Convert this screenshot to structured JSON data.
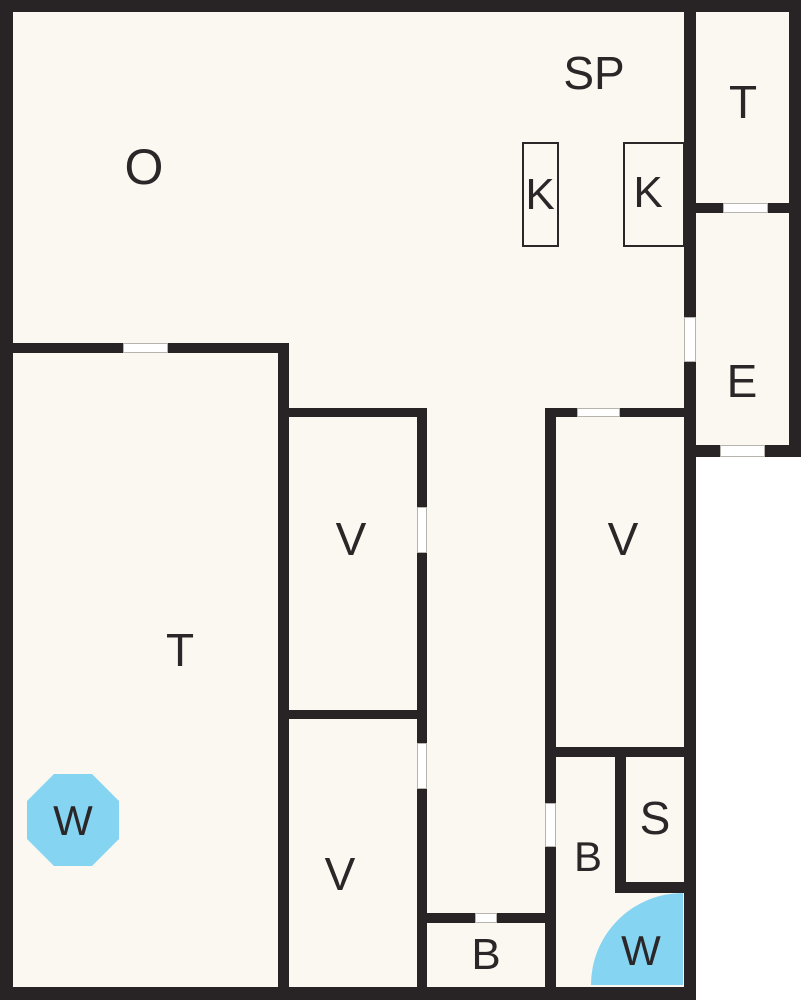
{
  "plan": {
    "canvas": {
      "width": 801,
      "height": 1000
    },
    "colors": {
      "outside": "#ffffff",
      "floor": "#faf8f1",
      "wall": "#282324",
      "door": "#ffffff",
      "door_frame": "#b7b3ad",
      "water": "#85d4f1",
      "text": "#2b2627"
    },
    "floors": [
      {
        "x": 13,
        "y": 12,
        "w": 671,
        "h": 975
      },
      {
        "x": 696,
        "y": 12,
        "w": 93,
        "h": 433
      }
    ],
    "walls": [
      {
        "x": 0,
        "y": 0,
        "w": 801,
        "h": 12
      },
      {
        "x": 0,
        "y": 0,
        "w": 13,
        "h": 1000
      },
      {
        "x": 0,
        "y": 987,
        "w": 696,
        "h": 13
      },
      {
        "x": 789,
        "y": 0,
        "w": 12,
        "h": 457
      },
      {
        "x": 684,
        "y": 0,
        "w": 12,
        "h": 317
      },
      {
        "x": 684,
        "y": 362,
        "w": 12,
        "h": 638
      },
      {
        "x": 684,
        "y": 445,
        "w": 36,
        "h": 12
      },
      {
        "x": 765,
        "y": 445,
        "w": 36,
        "h": 12
      },
      {
        "x": 684,
        "y": 203,
        "w": 39,
        "h": 10
      },
      {
        "x": 768,
        "y": 203,
        "w": 33,
        "h": 10
      },
      {
        "x": 0,
        "y": 343,
        "w": 123,
        "h": 10
      },
      {
        "x": 168,
        "y": 343,
        "w": 121,
        "h": 10
      },
      {
        "x": 278,
        "y": 343,
        "w": 11,
        "h": 644
      },
      {
        "x": 289,
        "y": 408,
        "w": 138,
        "h": 9
      },
      {
        "x": 417,
        "y": 408,
        "w": 10,
        "h": 99
      },
      {
        "x": 417,
        "y": 553,
        "w": 10,
        "h": 190
      },
      {
        "x": 417,
        "y": 789,
        "w": 10,
        "h": 198
      },
      {
        "x": 289,
        "y": 710,
        "w": 128,
        "h": 9
      },
      {
        "x": 545,
        "y": 408,
        "w": 32,
        "h": 9
      },
      {
        "x": 620,
        "y": 408,
        "w": 64,
        "h": 9
      },
      {
        "x": 545,
        "y": 408,
        "w": 11,
        "h": 395
      },
      {
        "x": 545,
        "y": 847,
        "w": 11,
        "h": 140
      },
      {
        "x": 556,
        "y": 747,
        "w": 128,
        "h": 10
      },
      {
        "x": 615,
        "y": 757,
        "w": 11,
        "h": 125
      },
      {
        "x": 615,
        "y": 882,
        "w": 69,
        "h": 11
      },
      {
        "x": 427,
        "y": 913,
        "w": 48,
        "h": 10
      },
      {
        "x": 497,
        "y": 913,
        "w": 59,
        "h": 10
      }
    ],
    "doors": [
      {
        "x": 123,
        "y": 343,
        "w": 45,
        "h": 10
      },
      {
        "x": 417,
        "y": 507,
        "w": 10,
        "h": 46
      },
      {
        "x": 417,
        "y": 743,
        "w": 10,
        "h": 46
      },
      {
        "x": 545,
        "y": 803,
        "w": 11,
        "h": 44
      },
      {
        "x": 684,
        "y": 317,
        "w": 12,
        "h": 45
      },
      {
        "x": 475,
        "y": 913,
        "w": 22,
        "h": 10
      },
      {
        "x": 577,
        "y": 408,
        "w": 43,
        "h": 9
      },
      {
        "x": 723,
        "y": 203,
        "w": 45,
        "h": 10
      },
      {
        "x": 720,
        "y": 445,
        "w": 45,
        "h": 12
      }
    ],
    "fixtures": [
      {
        "id": "k-box-left",
        "x": 522,
        "y": 142,
        "w": 37,
        "h": 105
      },
      {
        "id": "k-box-right",
        "x": 623,
        "y": 142,
        "w": 62,
        "h": 105
      }
    ],
    "water_features": [
      {
        "id": "water-octagon",
        "shape": "octagon",
        "x": 27,
        "y": 774,
        "w": 92,
        "h": 92
      },
      {
        "id": "water-quarter-circle",
        "shape": "quarter-circle",
        "x": 591,
        "y": 893,
        "w": 92,
        "h": 92
      }
    ],
    "room_labels": [
      {
        "id": "o",
        "text": "O",
        "x": 144,
        "y": 167,
        "size": 50
      },
      {
        "id": "sp",
        "text": "SP",
        "x": 594,
        "y": 73,
        "size": 46
      },
      {
        "id": "k-left",
        "text": "K",
        "x": 540,
        "y": 195,
        "size": 44
      },
      {
        "id": "k-right",
        "text": "K",
        "x": 648,
        "y": 193,
        "size": 44
      },
      {
        "id": "t-upper-right",
        "text": "T",
        "x": 743,
        "y": 102,
        "size": 46
      },
      {
        "id": "e",
        "text": "E",
        "x": 742,
        "y": 381,
        "size": 46
      },
      {
        "id": "v-middle",
        "text": "V",
        "x": 351,
        "y": 539,
        "size": 46
      },
      {
        "id": "v-right",
        "text": "V",
        "x": 623,
        "y": 539,
        "size": 46
      },
      {
        "id": "t-left",
        "text": "T",
        "x": 180,
        "y": 650,
        "size": 46
      },
      {
        "id": "v-bottom",
        "text": "V",
        "x": 340,
        "y": 874,
        "size": 46
      },
      {
        "id": "w-octagon",
        "text": "W",
        "x": 73,
        "y": 821,
        "size": 42
      },
      {
        "id": "b-right",
        "text": "B",
        "x": 588,
        "y": 857,
        "size": 42
      },
      {
        "id": "s",
        "text": "S",
        "x": 655,
        "y": 818,
        "size": 46
      },
      {
        "id": "b-bottom",
        "text": "B",
        "x": 486,
        "y": 955,
        "size": 44
      },
      {
        "id": "w-quarter",
        "text": "W",
        "x": 641,
        "y": 951,
        "size": 42
      }
    ]
  }
}
